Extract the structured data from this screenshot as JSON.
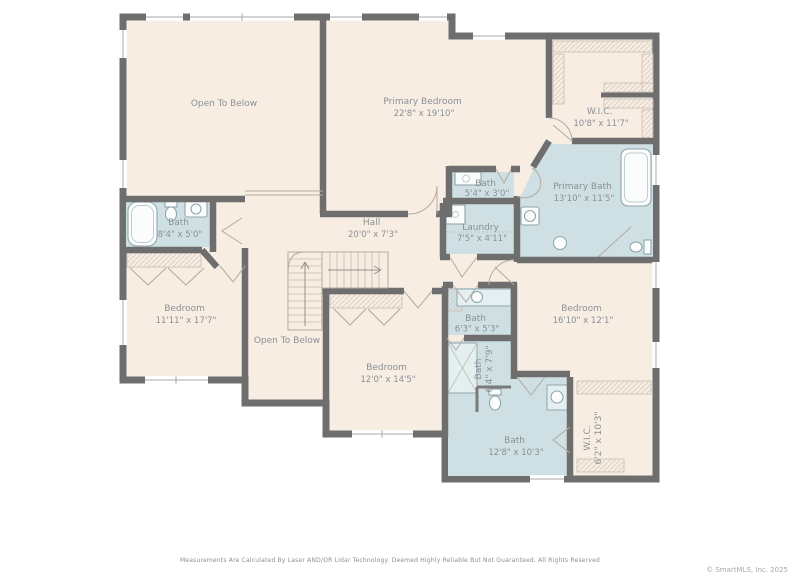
{
  "plan": {
    "colors": {
      "wall": "#6e6e6e",
      "floor": "#f7ede3",
      "wet_room": "#cfe0e4",
      "label_text": "#8b9096",
      "fixture_stroke": "#8fa6ab"
    },
    "rooms": [
      {
        "id": "open-to-below-upper",
        "name": "Open To Below",
        "dims": ""
      },
      {
        "id": "primary-bedroom",
        "name": "Primary Bedroom",
        "dims": "22'8\" x 19'10\""
      },
      {
        "id": "primary-wic",
        "name": "W.I.C.",
        "dims": "10'8\" x 11'7\""
      },
      {
        "id": "bath-hall",
        "name": "Bath",
        "dims": "5'4\" x 3'0\""
      },
      {
        "id": "primary-bath",
        "name": "Primary Bath",
        "dims": "13'10\" x 11'5\""
      },
      {
        "id": "laundry",
        "name": "Laundry",
        "dims": "7'5\" x 4'11\""
      },
      {
        "id": "hall",
        "name": "Hall",
        "dims": "20'0\" x 7'3\""
      },
      {
        "id": "bath-left",
        "name": "Bath",
        "dims": "8'4\" x 5'0\""
      },
      {
        "id": "bedroom-left",
        "name": "Bedroom",
        "dims": "11'11\" x 17'7\""
      },
      {
        "id": "open-to-below-lower",
        "name": "Open To Below",
        "dims": ""
      },
      {
        "id": "bedroom-center",
        "name": "Bedroom",
        "dims": "12'0\" x 14'5\""
      },
      {
        "id": "bedroom-right",
        "name": "Bedroom",
        "dims": "16'10\" x 12'1\""
      },
      {
        "id": "bath-63",
        "name": "Bath",
        "dims": "6'3\" x 5'3\""
      },
      {
        "id": "bath-64",
        "name": "Bath",
        "dims": "6'4\" x 7'9\""
      },
      {
        "id": "bath-128",
        "name": "Bath",
        "dims": "12'8\" x 10'3\""
      },
      {
        "id": "wic-lower",
        "name": "W.I.C.",
        "dims": "6'2\" x 10'3\""
      }
    ]
  },
  "footer": {
    "disclaimer": "Measurements Are Calculated By Laser AND/OR Lidar Technology. Deemed Highly Reliable But Not Guaranteed. All Rights Reserved",
    "copyright": "© SmartMLS, Inc.  2025"
  }
}
